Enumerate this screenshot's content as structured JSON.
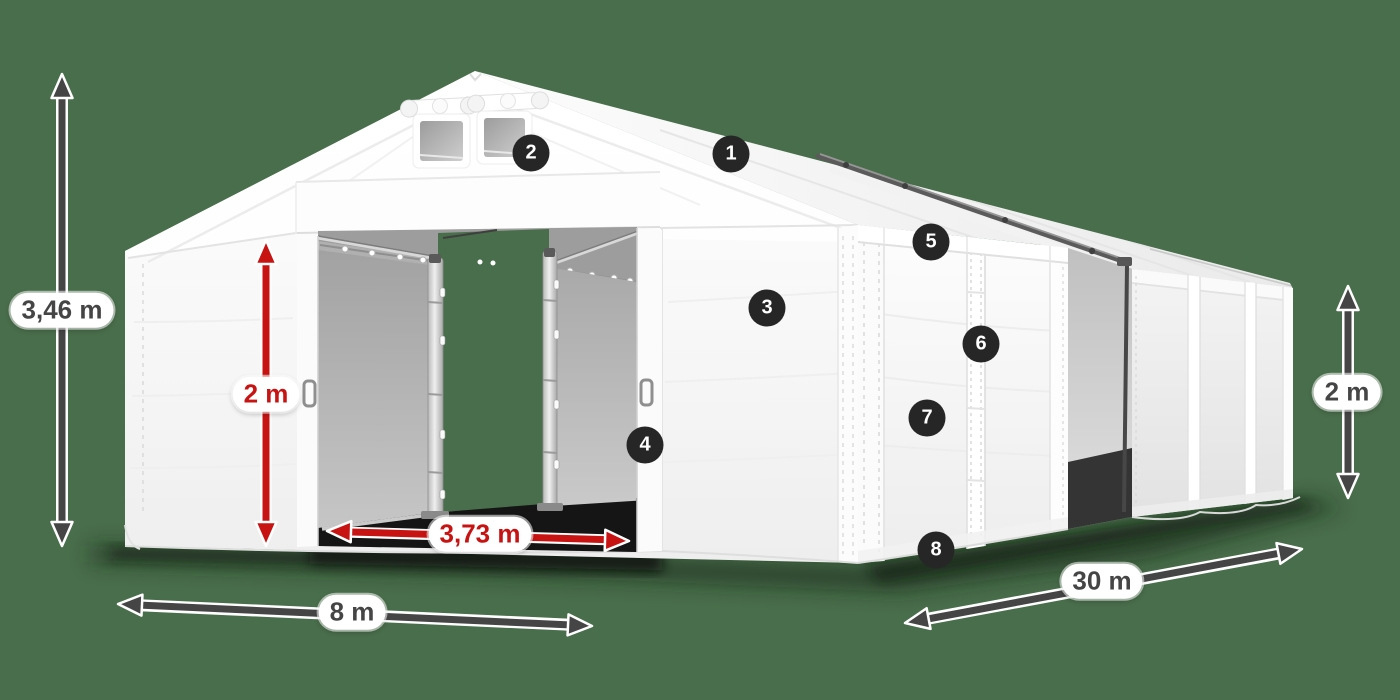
{
  "diagram": {
    "colors": {
      "bg": "#496e4b",
      "red": "#c81313",
      "dim": "#454545",
      "badge": "#262626"
    },
    "dimensions": {
      "total_height": "3,46 m",
      "door_height": "2 m",
      "door_width": "3,73 m",
      "front_width": "8 m",
      "side_length": "30 m",
      "side_wall_height": "2 m"
    },
    "markers": [
      "1",
      "2",
      "3",
      "4",
      "5",
      "6",
      "7",
      "8"
    ]
  }
}
